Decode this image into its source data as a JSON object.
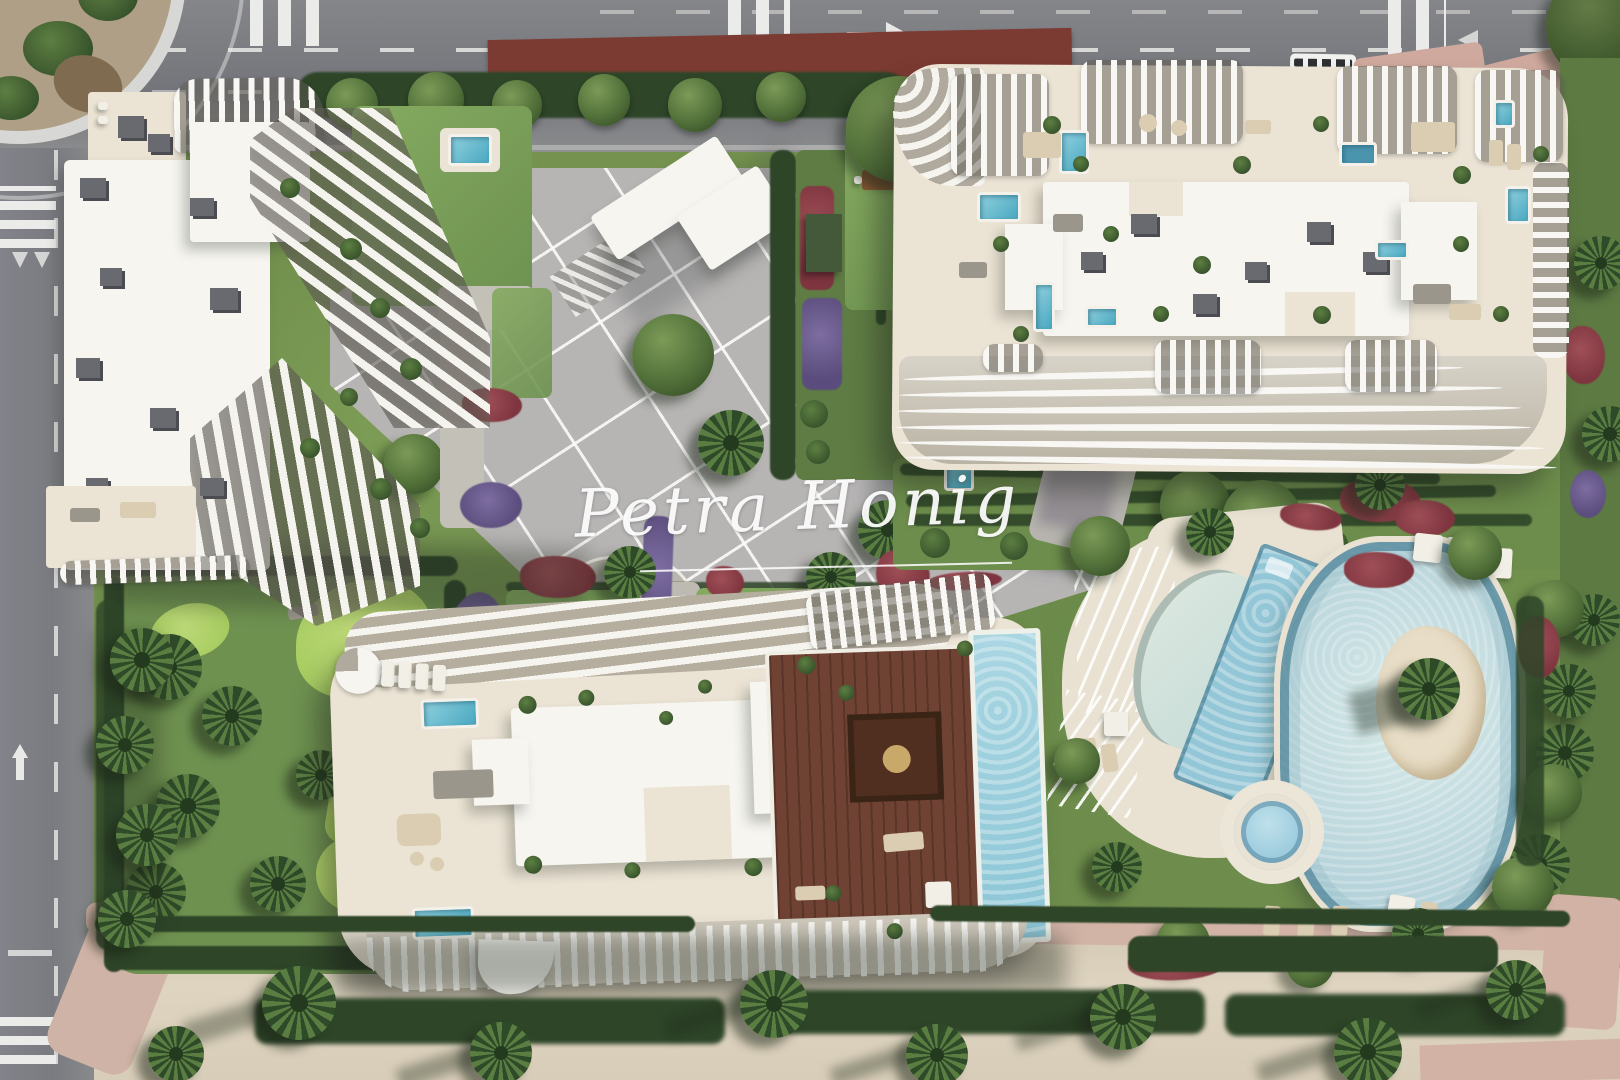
{
  "watermark": {
    "text": "Petra Honig"
  },
  "palette": {
    "asphalt": "#7e7f83",
    "road_marking": "#e9e9e7",
    "building_white": "#f5f4ef",
    "rooftop_cream": "#ebe3d4",
    "grass_green": "#74924f",
    "lawn_bright": "#b7d56e",
    "hedge_dark": "#2e4528",
    "pool_teal": "#49a8c0",
    "lagoon_pale": "#c6dee1",
    "wood_deck": "#6f4233",
    "sand_beige": "#dcd2bd",
    "promenade_pink": "#d2b2a5",
    "flower_red": "#8a3d47",
    "flower_purple": "#6b5b8c",
    "island_sand": "#e8ddc6"
  }
}
